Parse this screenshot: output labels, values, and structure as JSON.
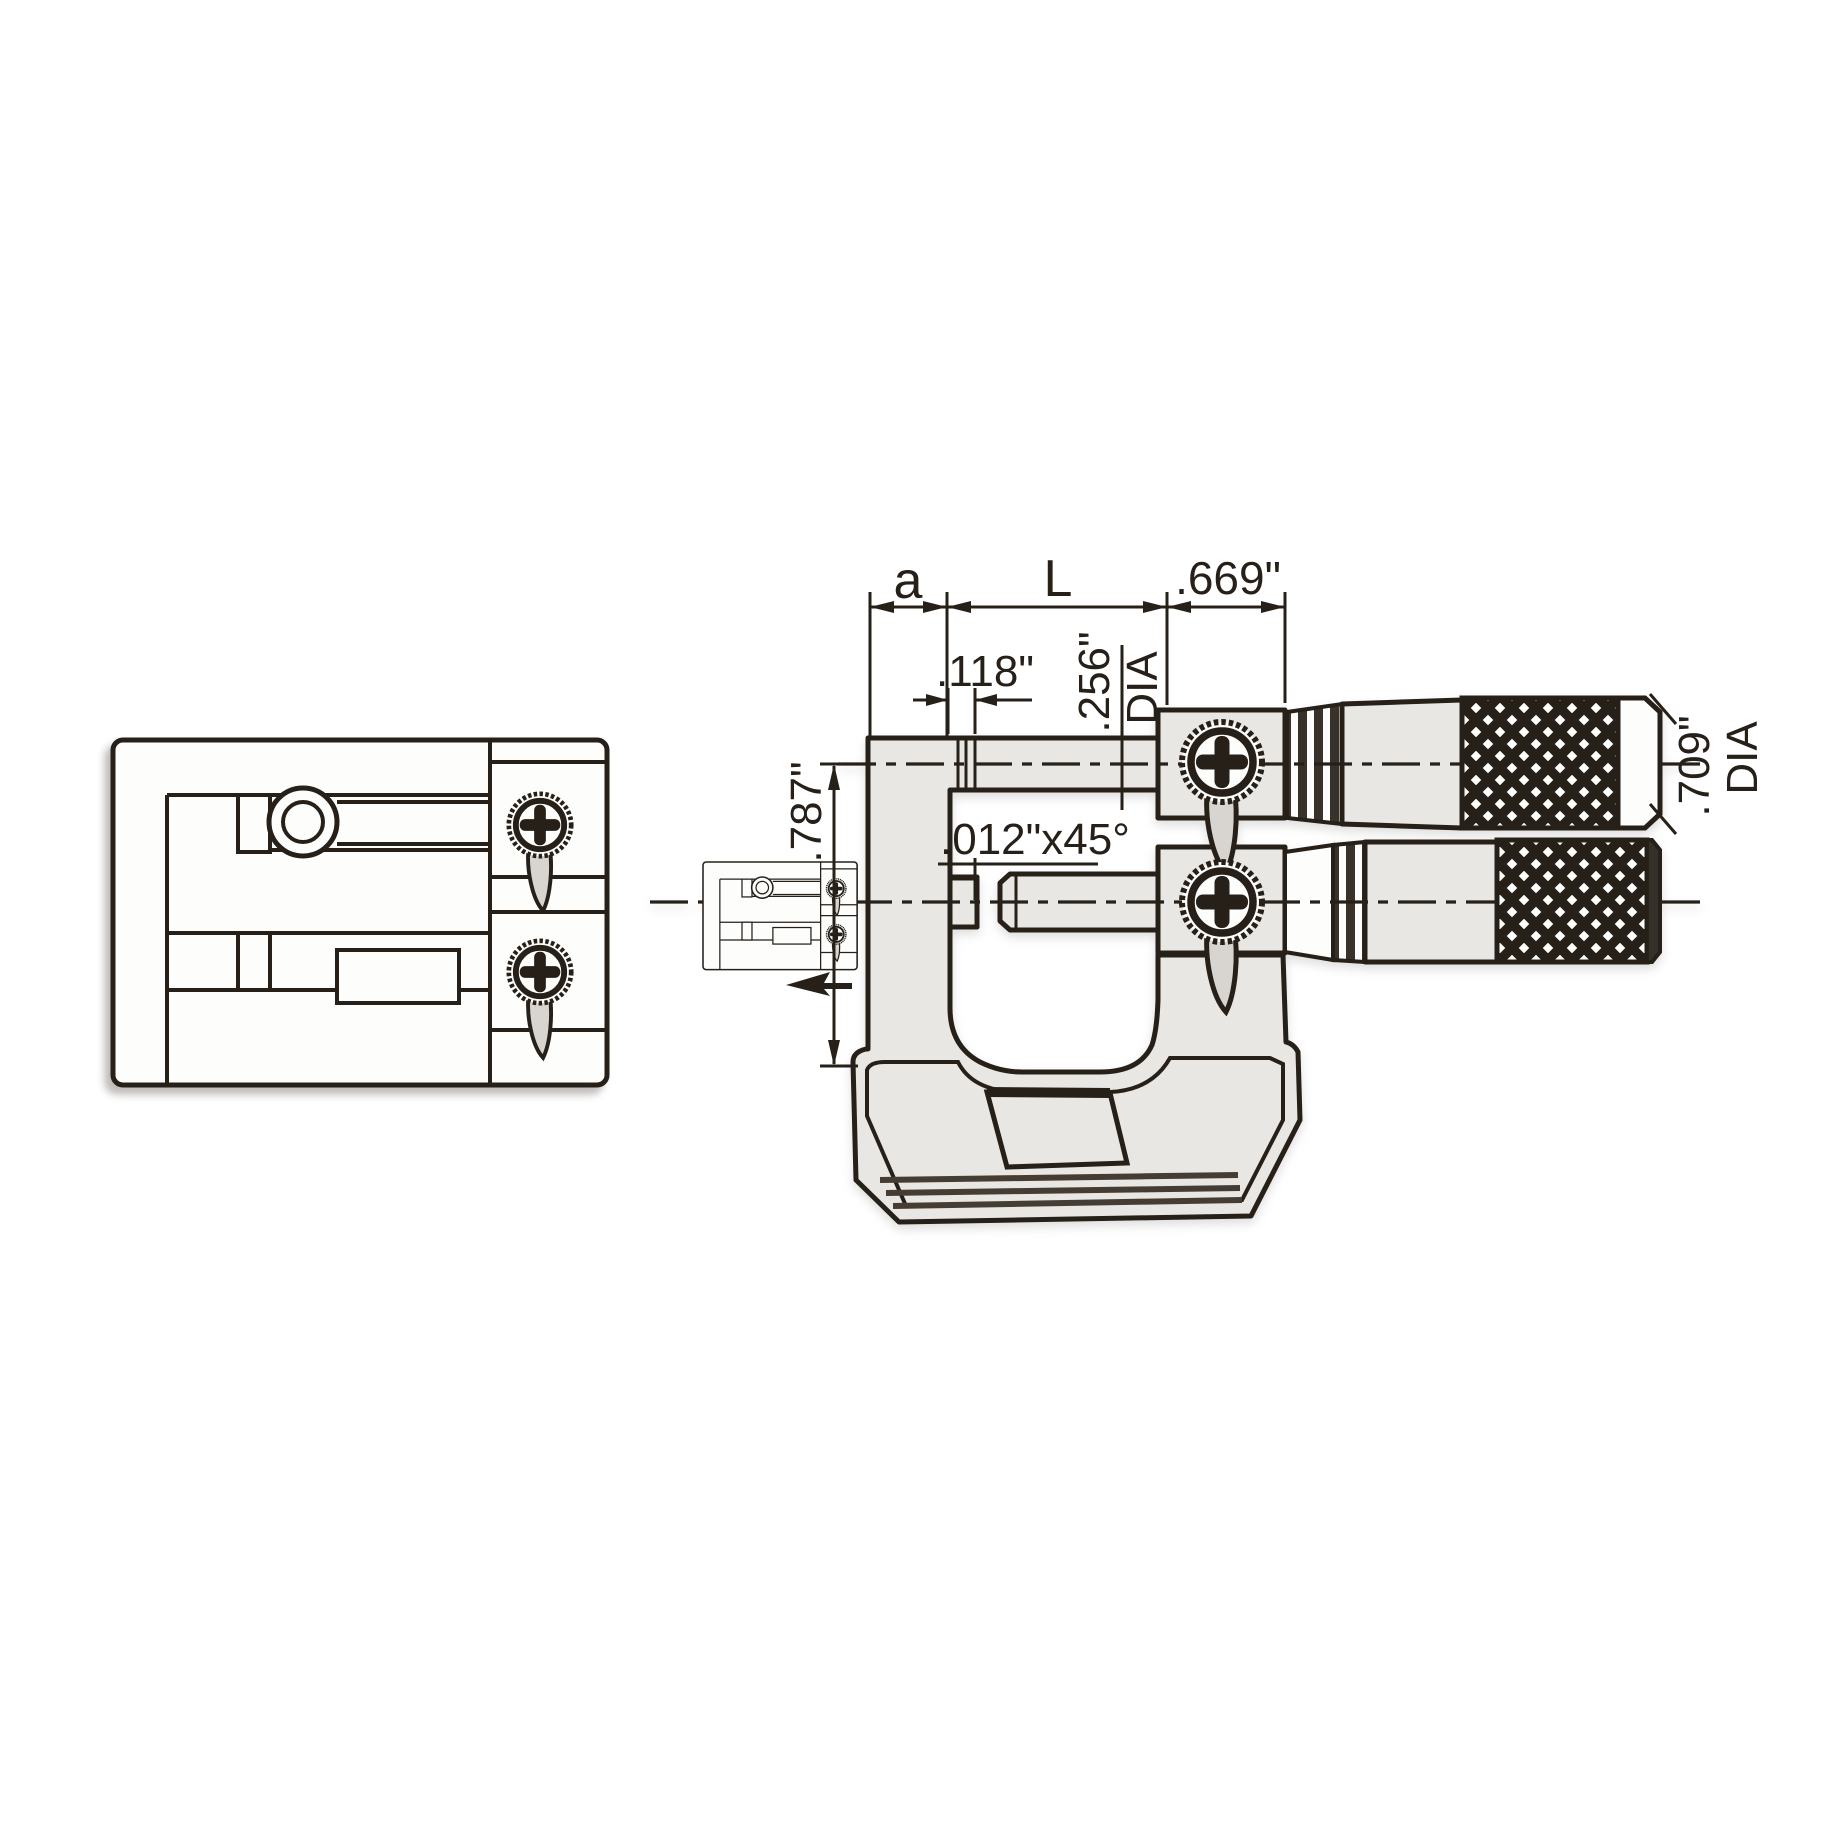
{
  "meta": {
    "kind": "technical line drawing",
    "subject": "dual-spindle micrometer head, front view with top view and detail inset"
  },
  "colors": {
    "ink": "#262019",
    "metal_fill": "#e9e7e4",
    "pointer_fill": "#d8d5d0",
    "knurl_dark": "#262019",
    "background": "#ffffff"
  },
  "dimensions": {
    "a": "a",
    "L": "L",
    "head_width": ".669\"",
    "anvil_step": ".118\"",
    "spindle_dia": ".256\"",
    "spindle_dia_suffix": "DIA",
    "frame_height": ".787\"",
    "chamfer": ".012\"x45°",
    "thimble_dia": ".709\"",
    "thimble_dia_suffix": "DIA"
  }
}
